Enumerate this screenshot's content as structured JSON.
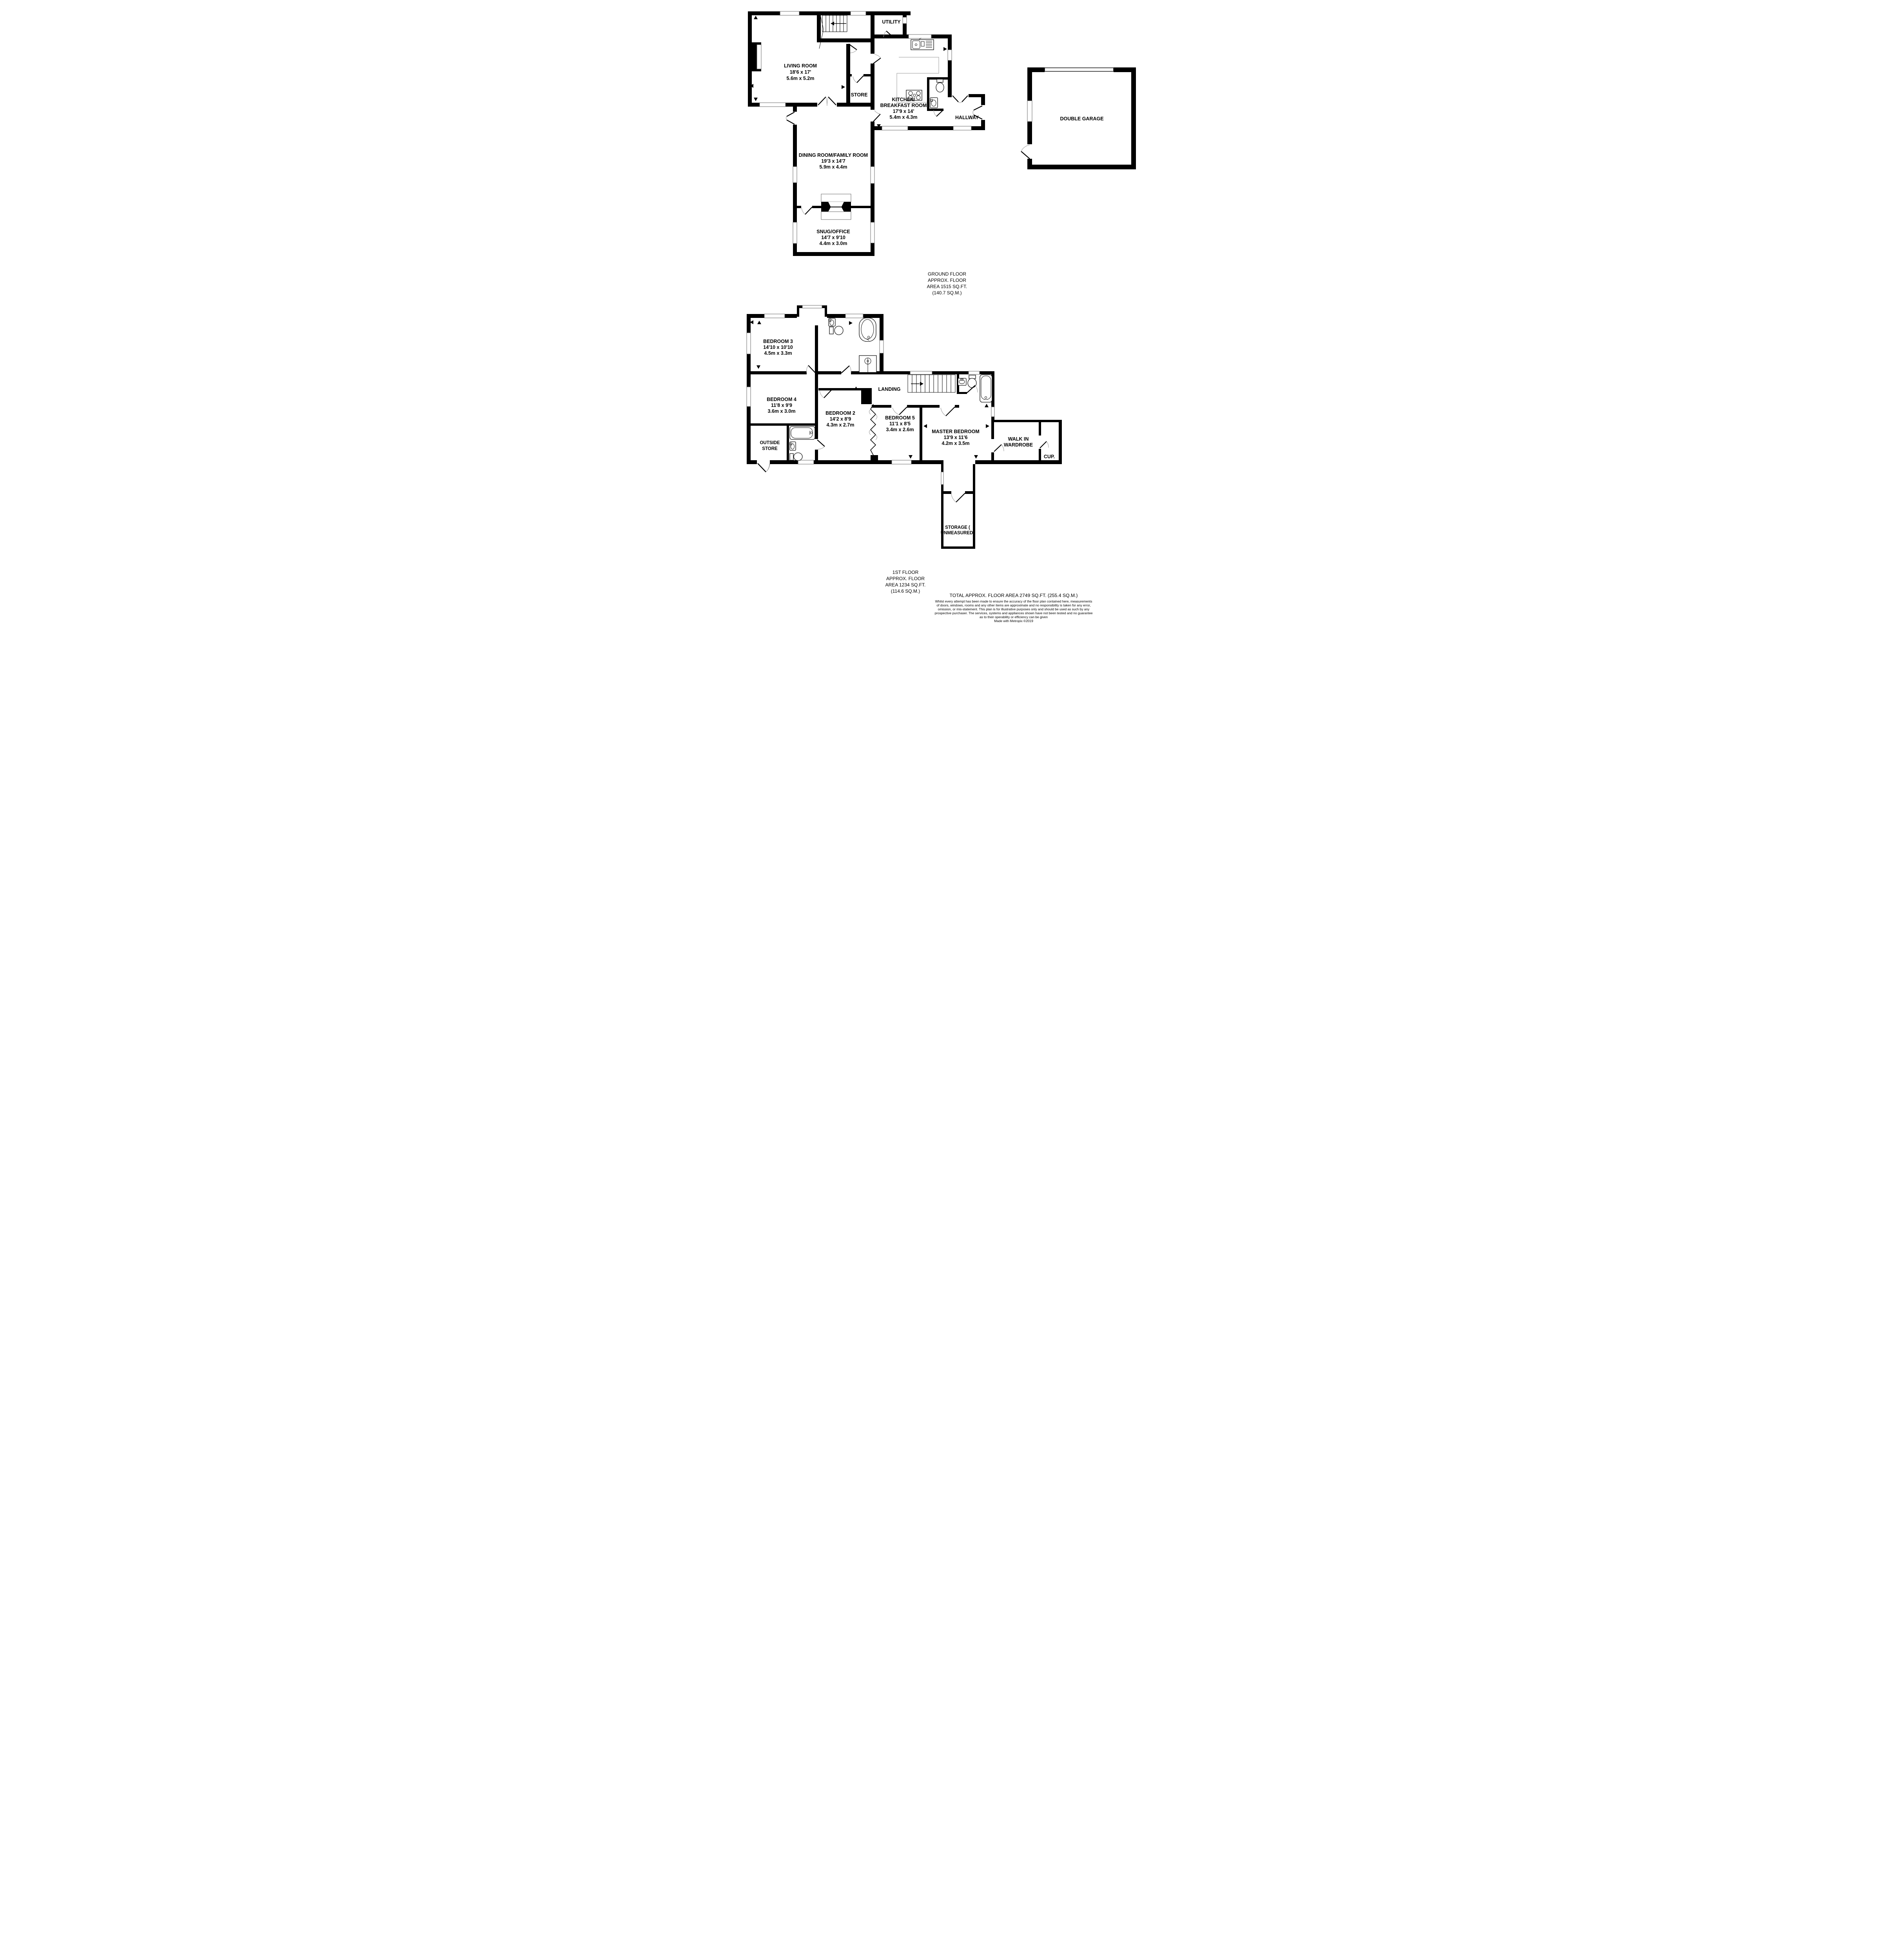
{
  "ground_floor": {
    "rooms": {
      "living": {
        "lines": [
          "LIVING ROOM",
          "18'6 x 17'",
          "5.6m x 5.2m"
        ]
      },
      "utility": {
        "lines": [
          "UTILITY"
        ]
      },
      "store": {
        "lines": [
          "STORE"
        ]
      },
      "kitchen": {
        "lines": [
          "KITCHEN/",
          "BREAKFAST ROOM",
          "17'9 x 14'",
          "5.4m x 4.3m"
        ]
      },
      "hallway": {
        "lines": [
          "HALLWAY"
        ]
      },
      "dining": {
        "lines": [
          "DINING ROOM/FAMILY ROOM",
          "19'3 x 14'7",
          "5.9m x 4.4m"
        ]
      },
      "snug": {
        "lines": [
          "SNUG/OFFICE",
          "14'7 x 9'10",
          "4.4m x 3.0m"
        ]
      },
      "garage": {
        "lines": [
          "DOUBLE GARAGE"
        ]
      }
    },
    "caption": {
      "lines": [
        "GROUND FLOOR",
        "APPROX. FLOOR",
        "AREA 1515 SQ.FT.",
        "(140.7 SQ.M.)"
      ]
    }
  },
  "first_floor": {
    "rooms": {
      "bedroom3": {
        "lines": [
          "BEDROOM 3",
          "14'10 x 10'10",
          "4.5m x 3.3m"
        ]
      },
      "bedroom4": {
        "lines": [
          "BEDROOM 4",
          "11'8 x 9'9",
          "3.6m x 3.0m"
        ]
      },
      "outside_store": {
        "lines": [
          "OUTSIDE",
          "STORE"
        ]
      },
      "bedroom2": {
        "lines": [
          "BEDROOM 2",
          "14'2 x 8'9",
          "4.3m x 2.7m"
        ]
      },
      "bedroom5": {
        "lines": [
          "BEDROOM 5",
          "11'1 x 8'5",
          "3.4m x 2.6m"
        ]
      },
      "master": {
        "lines": [
          "MASTER BEDROOM",
          "13'9 x 11'6",
          "4.2m x 3.5m"
        ]
      },
      "landing": {
        "lines": [
          "LANDING"
        ]
      },
      "wardrobe": {
        "lines": [
          "WALK IN",
          "WARDROBE"
        ]
      },
      "cupboard": {
        "lines": [
          "CUP."
        ]
      },
      "storage": {
        "lines": [
          "STORAGE (",
          "UNMEASURED)"
        ]
      }
    },
    "caption": {
      "lines": [
        "1ST FLOOR",
        "APPROX. FLOOR",
        "AREA 1234 SQ.FT.",
        "(114.6 SQ.M.)"
      ]
    }
  },
  "summary": {
    "total_line": "TOTAL APPROX. FLOOR AREA 2749 SQ.FT. (255.4 SQ.M.)",
    "disclaimer": [
      "Whilst every attempt has been made to ensure the accuracy of the floor plan contained here, measurements",
      "of doors, windows, rooms and any other items are approximate and no responsibility is taken for any error,",
      "omission, or mis-statement. This plan is for illustrative purposes only and should be used as such by any",
      "prospective purchaser. The services, systems and appliances shown have not been tested and no guarantee",
      "as to their operability or efficiency can be given",
      "Made with Metropix ©2019"
    ]
  },
  "colors": {
    "wall": "#000000",
    "arc": "#999999",
    "background": "#ffffff"
  }
}
